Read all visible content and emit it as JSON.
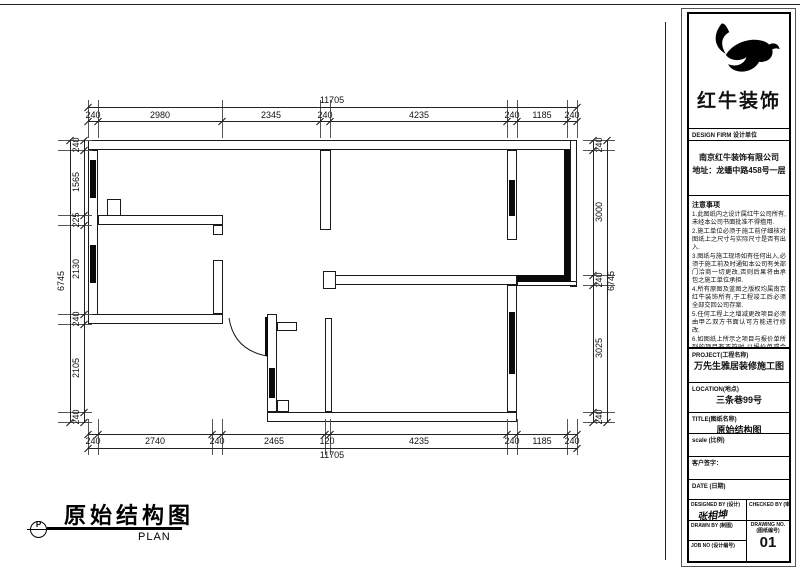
{
  "plan": {
    "caption": {
      "symbol": "P",
      "title": "原始结构图",
      "subtitle": "PLAN"
    },
    "dims": {
      "top": {
        "overall": "11705",
        "segments": [
          "240",
          "2980",
          "2345",
          "240",
          "4235",
          "240",
          "1185",
          "240"
        ]
      },
      "bottom": {
        "overall": "11705",
        "segments": [
          "240",
          "2740",
          "240",
          "2465",
          "120",
          "4235",
          "240",
          "1185",
          "240"
        ]
      },
      "left": {
        "overall": "6745",
        "segments": [
          "240",
          "1565",
          "225",
          "2130",
          "240",
          "2105",
          "240"
        ]
      },
      "right": {
        "overall": "6745",
        "segments": [
          "240",
          "3000",
          "240",
          "3025",
          "240"
        ]
      }
    }
  },
  "titleblock": {
    "logo_text": "红牛装饰",
    "design_firm_label": "DESIGN FIRM 设计单位",
    "company_name": "南京红牛装饰有限公司",
    "company_address": "地址：龙蟠中路458号一层",
    "notes_title": "注意事项",
    "notes": [
      "1.此图纸内之设计属红牛公司所有,未经本公司书面批准不得擅用.",
      "2.施工单位必须于施工前仔细核对图纸上之尺寸与实际尺寸是否有出入.",
      "3.图纸与施工现场如有任何出入,必须于施工前及时通知本公司有关部门洽商一切更改,否则后果将由承包之施工单位承担.",
      "4.所有原图及蓝图之版权均属南京红牛装饰所有,于工程竣工后必须全部交回公司存案.",
      "5.任何工程上之增减更改项目必须由甲乙双方书面认可方能进行修改.",
      "6.如图纸上所示之项目与报价单所列的项目有不符时,以报价单或合同为准.",
      "7.不得翻印图纸."
    ],
    "project_label": "PROJECT(工程名称)",
    "project_value": "万先生雅居装修施工图",
    "location_label": "LOCATION(地点)",
    "location_value": "三条巷99号",
    "title_label": "TITLE(图纸名称)",
    "title_value": "原始结构图",
    "scale_label": "scale (比例)",
    "client_sign_label": "客户签字：",
    "date_label": "DATE (日期)",
    "designed_by_label": "DESIGNED BY (设计)",
    "designed_by_signature": "张相坤",
    "checked_by_label": "CHECKED BY (审核)",
    "drawn_by_label": "DRAWN BY (制图)",
    "job_no_label": "JOB NO (设计编号)",
    "drawing_no_label": "DRAWING NO. (图纸编号)",
    "drawing_no_value": "01"
  }
}
